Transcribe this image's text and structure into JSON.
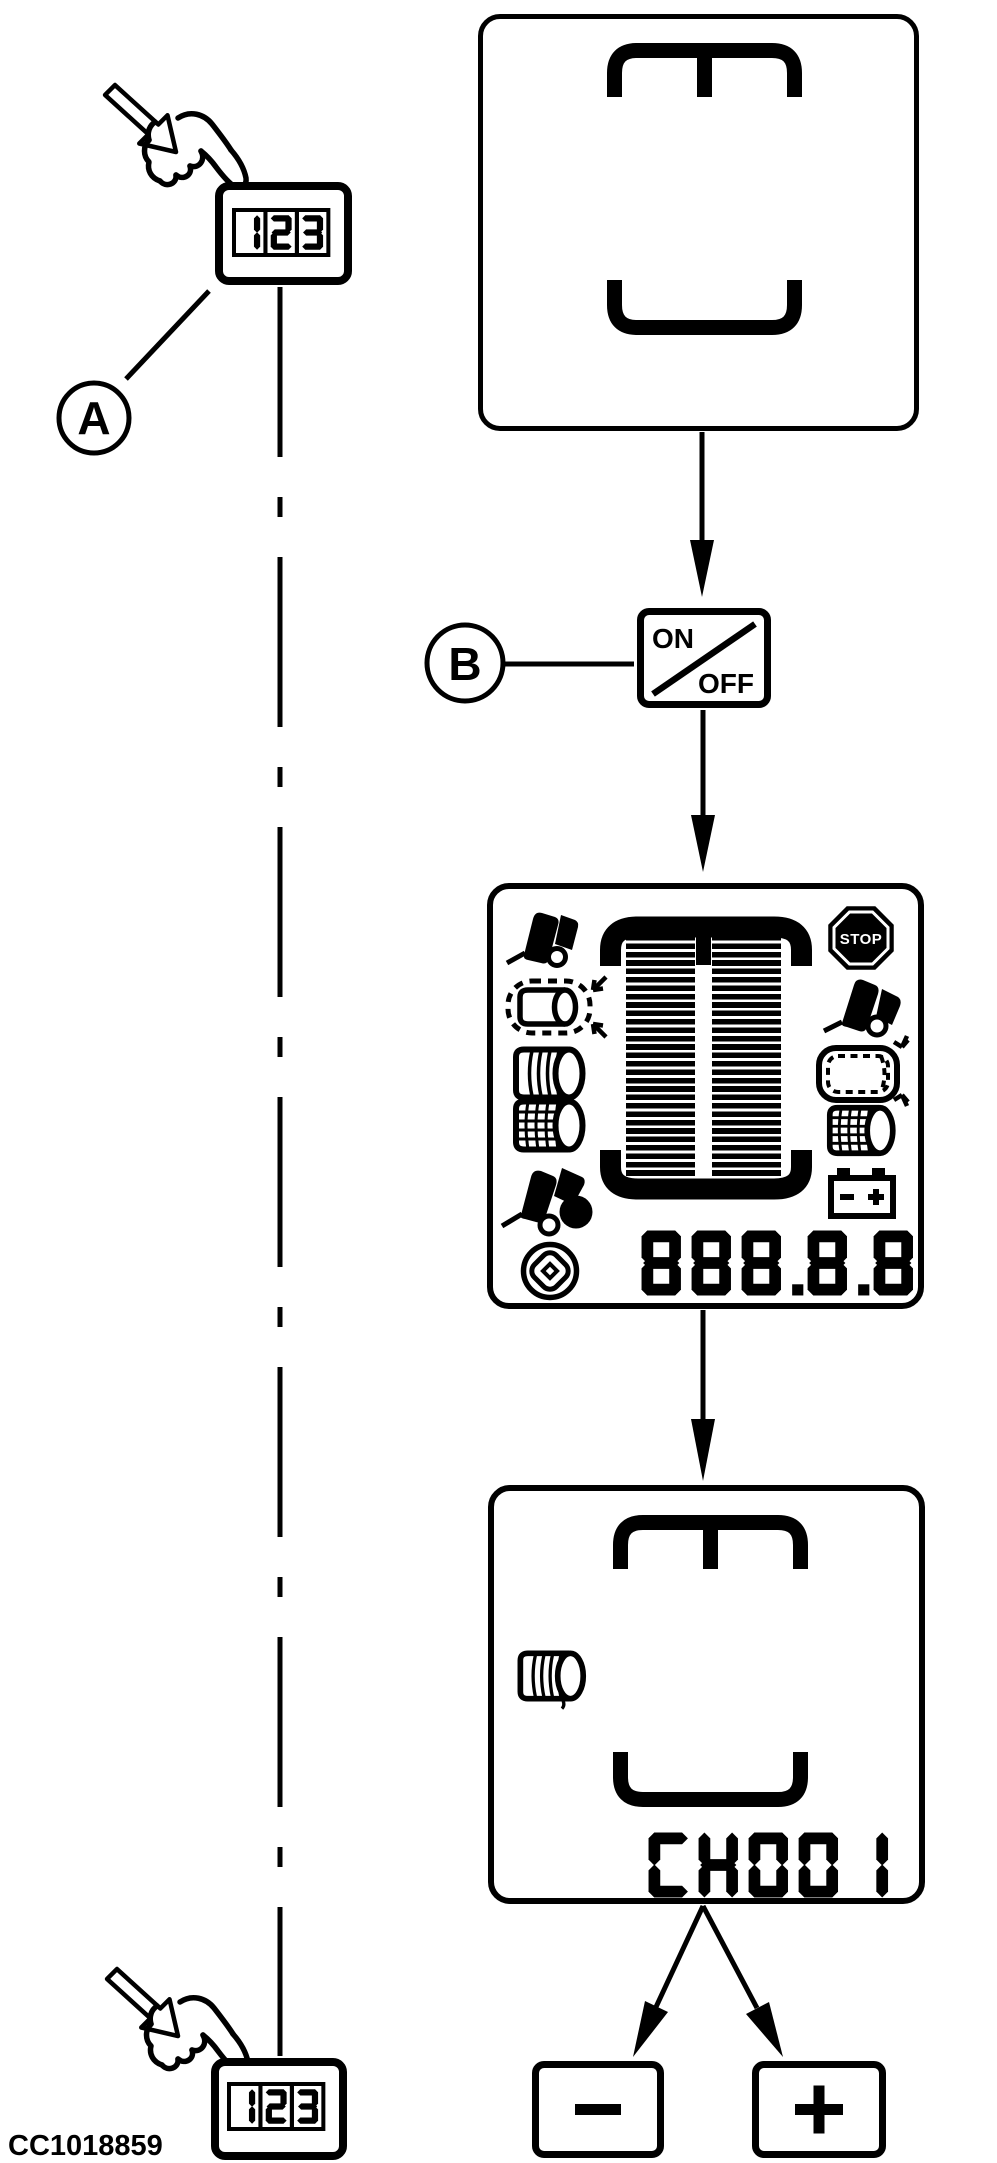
{
  "figure_code": "CC1018859",
  "callouts": {
    "a": "A",
    "b": "B"
  },
  "monitor_button": {
    "display": "123"
  },
  "power_button": {
    "on": "ON",
    "off": "OFF"
  },
  "adjust_buttons": {
    "minus": "−",
    "plus": "+"
  },
  "screens": {
    "startup": {
      "symbol": "bale-chamber-brackets"
    },
    "overview": {
      "counter": "888.8.8",
      "stop_label": "STOP",
      "battery_minus": "−",
      "battery_plus": "+",
      "icons": [
        "tailgate-open",
        "bale-size",
        "twine-wrap",
        "net-wrap",
        "bale-eject",
        "knife-rotor",
        "stop",
        "tailgate-open",
        "bale-size",
        "net-wrap",
        "battery"
      ]
    },
    "channel": {
      "value": "CH001",
      "icon": "twine-wrap"
    }
  }
}
